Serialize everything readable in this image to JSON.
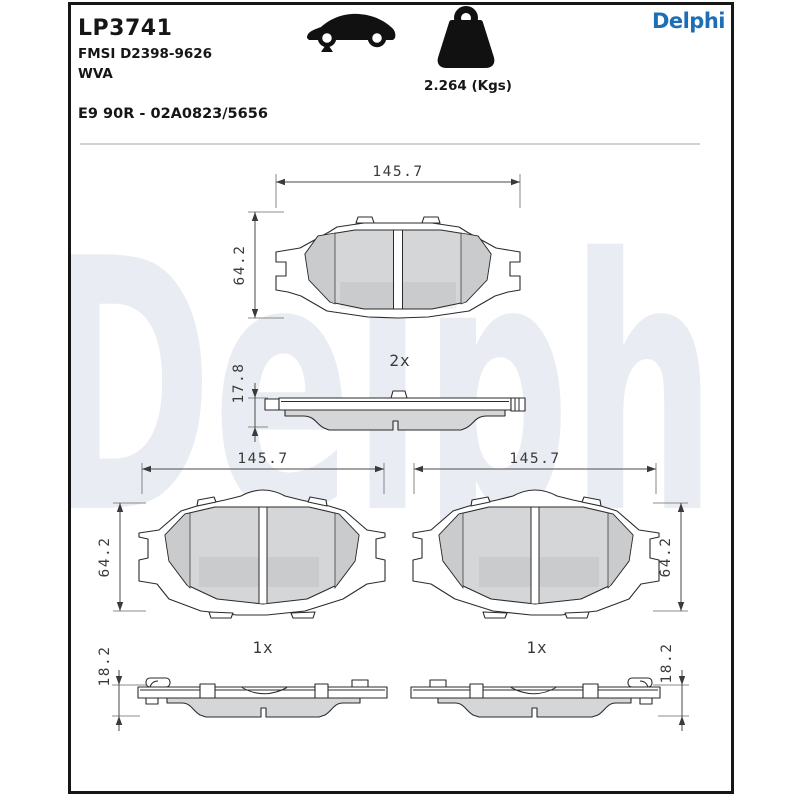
{
  "watermark": "Delphi",
  "header": {
    "part_number": "LP3741",
    "fmsi_code": "FMSI D2398-9626",
    "wva_code": "WVA",
    "homologation": "E9 90R - 02A0823/5656",
    "weight": "2.264 (Kgs)",
    "brand": "Delphi"
  },
  "icons": {
    "vehicle": "car-front-axle-icon",
    "mass": "weight-icon"
  },
  "colors": {
    "brand_blue": "#1c6fb7",
    "line": "#2b2b2b",
    "friction_gray": "#d5d6d8",
    "watermark_gray": "#e9edf3"
  },
  "drawings": {
    "pad_pair_front": {
      "width": "145.7",
      "height": "64.2",
      "quantity": "2x"
    },
    "pad_pair_profile": {
      "thickness": "17.8"
    },
    "pad_left_front": {
      "width": "145.7",
      "height": "64.2",
      "quantity": "1x"
    },
    "pad_right_front": {
      "width": "145.7",
      "height": "64.2",
      "quantity": "1x"
    },
    "pad_left_profile": {
      "thickness": "18.2"
    },
    "pad_right_profile": {
      "thickness": "18.2"
    }
  }
}
